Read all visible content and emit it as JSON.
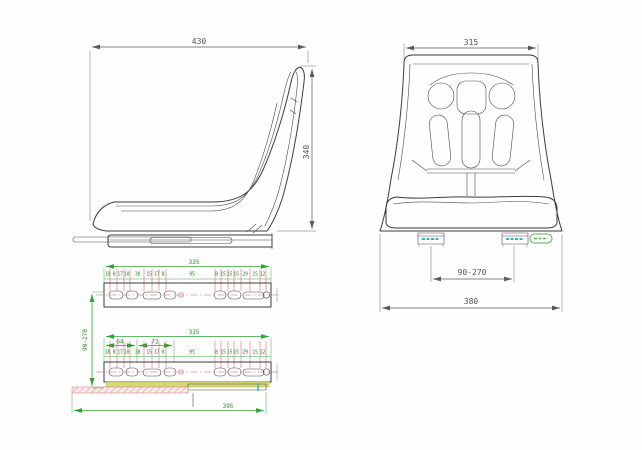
{
  "side_view": {
    "width_dim": "430",
    "height_dim": "340"
  },
  "front_view": {
    "top_width_dim": "315",
    "mount_span_dim": "90-270",
    "base_width_dim": "380"
  },
  "rail_top_view": {
    "length_dim": "325",
    "hole_dims": [
      "18",
      "8",
      "17",
      "10",
      "38",
      "15",
      "17",
      "8",
      "95",
      "8",
      "15",
      "15",
      "15",
      "29",
      "15",
      "12"
    ]
  },
  "rail_assembly_view": {
    "length_dim": "325",
    "left_group_dim": "64",
    "right_group_dim": "72",
    "hole_dims": [
      "18",
      "8",
      "17",
      "10",
      "38",
      "15",
      "17",
      "8",
      "95",
      "8",
      "15",
      "15",
      "15",
      "29",
      "15",
      "12"
    ],
    "rail_span_dim": "90-270",
    "base_length_dim": "395"
  },
  "colors": {
    "outline": "#3c3c3c",
    "dimension_dark": "#5a5a5a",
    "dimension_green": "#2fa436",
    "extension_red": "#cc5252",
    "centerline_red": "#d06060",
    "strip_yellow": "#d8d875",
    "hatch_pink": "#dd8f8f",
    "accent_cyan": "#30b8b8",
    "accent_green": "#55b055"
  }
}
